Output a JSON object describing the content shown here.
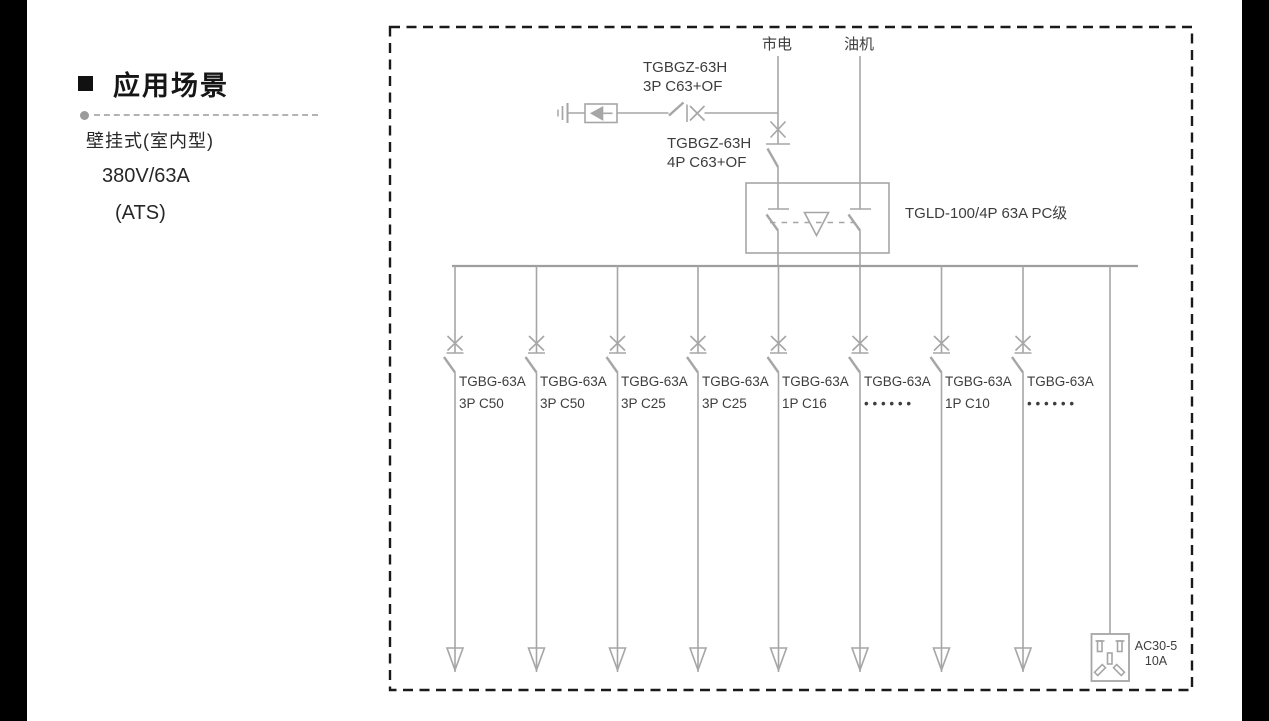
{
  "left_panel": {
    "heading": "应用场景",
    "mount_type": "壁挂式(室内型)",
    "rating": "380V/63A",
    "mode": "(ATS)"
  },
  "diagram": {
    "mains_label": "市电",
    "generator_label": "油机",
    "spd_branch_breaker": {
      "model": "TGBGZ-63H",
      "spec": "3P C63+OF"
    },
    "incoming_breaker": {
      "model": "TGBGZ-63H",
      "spec": "4P C63+OF"
    },
    "ats_switch_label": "TGLD-100/4P 63A PC级",
    "socket": {
      "model": "AC30-5",
      "rating": "10A"
    },
    "feeders": [
      {
        "model": "TGBG-63A",
        "spec": "3P C50"
      },
      {
        "model": "TGBG-63A",
        "spec": "3P C50"
      },
      {
        "model": "TGBG-63A",
        "spec": "3P C25"
      },
      {
        "model": "TGBG-63A",
        "spec": "3P C25"
      },
      {
        "model": "TGBG-63A",
        "spec": "1P C16"
      },
      {
        "model": "TGBG-63A",
        "spec": "• • • • • •"
      },
      {
        "model": "TGBG-63A",
        "spec": "1P C10"
      },
      {
        "model": "TGBG-63A",
        "spec": "• • • • • •"
      }
    ],
    "colors": {
      "line_gray": "#a6a6a6",
      "label_text": "#3d3d3d",
      "border_dash": "#1a1a1a",
      "side_bars": "#000000"
    }
  }
}
